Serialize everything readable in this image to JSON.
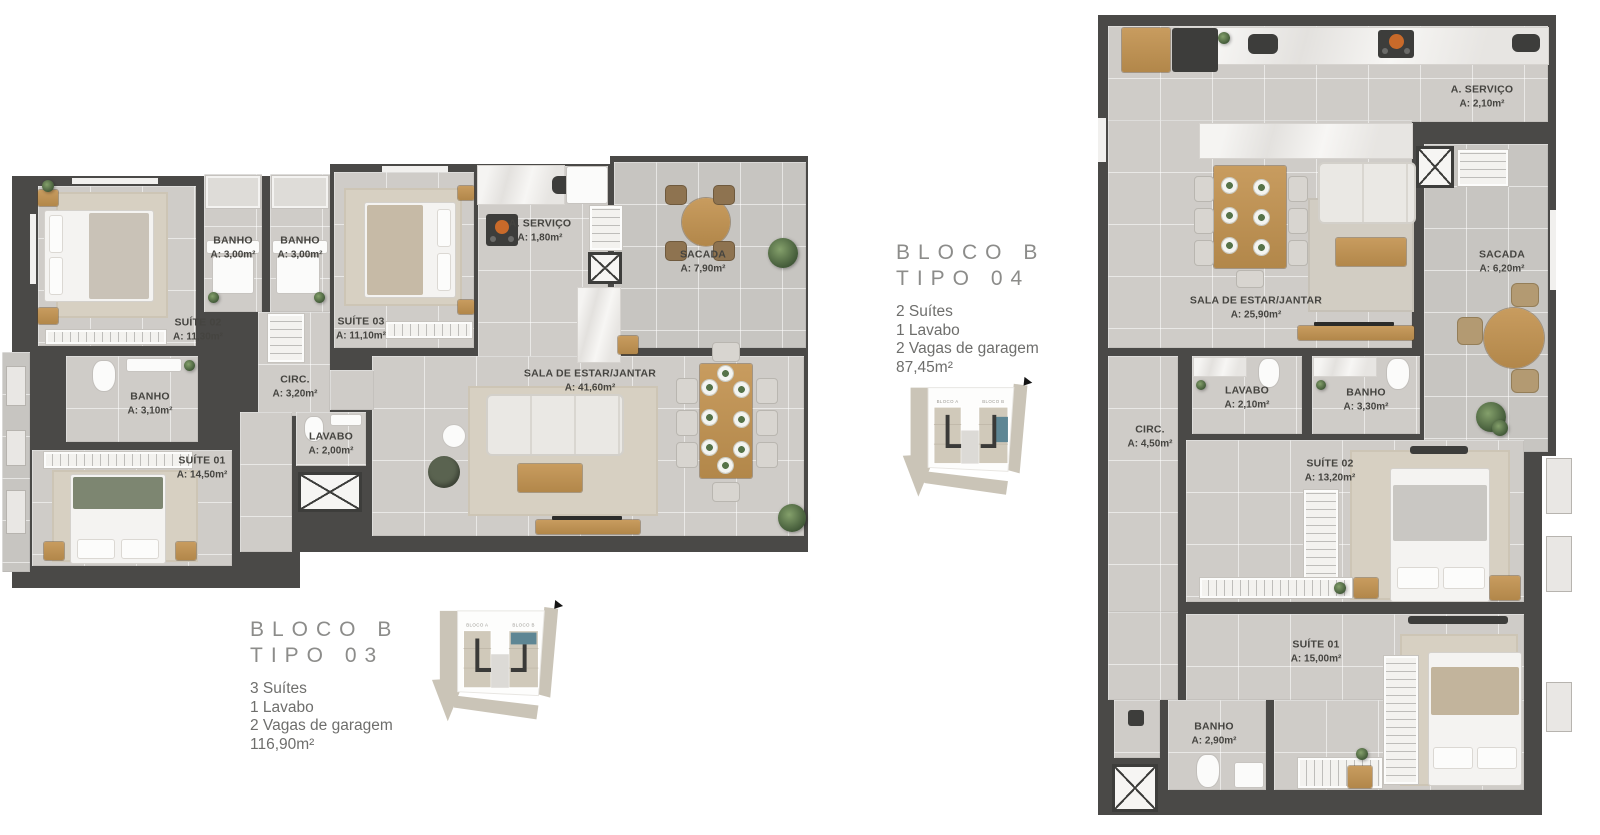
{
  "colors": {
    "wall": "#4a4947",
    "floor": "#cfccc8",
    "balcony_floor": "#c7c5c1",
    "wood": "#c0914f",
    "teal_highlight": "#5e8694",
    "road": "#cac4b7",
    "title_gray": "#8c8c8a",
    "text_gray": "#6e6e6c",
    "label_dark": "#454440"
  },
  "t03": {
    "rooms": {
      "suite02": {
        "name": "SUÍTE 02",
        "area": "A: 11,30m²"
      },
      "banho_a": {
        "name": "BANHO",
        "area": "A: 3,00m²"
      },
      "banho_b": {
        "name": "BANHO",
        "area": "A: 3,00m²"
      },
      "suite03": {
        "name": "SUÍTE 03",
        "area": "A: 11,10m²"
      },
      "servico": {
        "name": "A. SERVIÇO",
        "area": "A: 1,80m²"
      },
      "sacada": {
        "name": "SACADA",
        "area": "A: 7,90m²"
      },
      "circ": {
        "name": "CIRC.",
        "area": "A: 3,20m²"
      },
      "banho_c": {
        "name": "BANHO",
        "area": "A: 3,10m²"
      },
      "suite01": {
        "name": "SUÍTE 01",
        "area": "A: 14,50m²"
      },
      "lavabo": {
        "name": "LAVABO",
        "area": "A: 2,00m²"
      },
      "sala": {
        "name": "SALA DE ESTAR/JANTAR",
        "area": "A: 41,60m²"
      }
    },
    "info": {
      "block": "BLOCO B",
      "tipo": "TIPO 03",
      "features": [
        "3 Suítes",
        "1 Lavabo",
        "2 Vagas de garagem"
      ],
      "total_area": "116,90m²"
    },
    "keyplan": {
      "bloco_a": "BLOCO A",
      "bloco_b": "BLOCO B"
    }
  },
  "t04": {
    "rooms": {
      "servico": {
        "name": "A. SERVIÇO",
        "area": "A: 2,10m²"
      },
      "sala": {
        "name": "SALA DE ESTAR/JANTAR",
        "area": "A: 25,90m²"
      },
      "sacada": {
        "name": "SACADA",
        "area": "A: 6,20m²"
      },
      "lavabo": {
        "name": "LAVABO",
        "area": "A: 2,10m²"
      },
      "banho_a": {
        "name": "BANHO",
        "area": "A: 3,30m²"
      },
      "circ": {
        "name": "CIRC.",
        "area": "A: 4,50m²"
      },
      "suite02": {
        "name": "SUÍTE 02",
        "area": "A: 13,20m²"
      },
      "suite01": {
        "name": "SUÍTE 01",
        "area": "A: 15,00m²"
      },
      "banho_b": {
        "name": "BANHO",
        "area": "A: 2,90m²"
      }
    },
    "info": {
      "block": "BLOCO B",
      "tipo": "TIPO 04",
      "features": [
        "2 Suítes",
        "1 Lavabo",
        "2 Vagas de garagem"
      ],
      "total_area": "87,45m²"
    },
    "keyplan": {
      "bloco_a": "BLOCO A",
      "bloco_b": "BLOCO B"
    }
  }
}
